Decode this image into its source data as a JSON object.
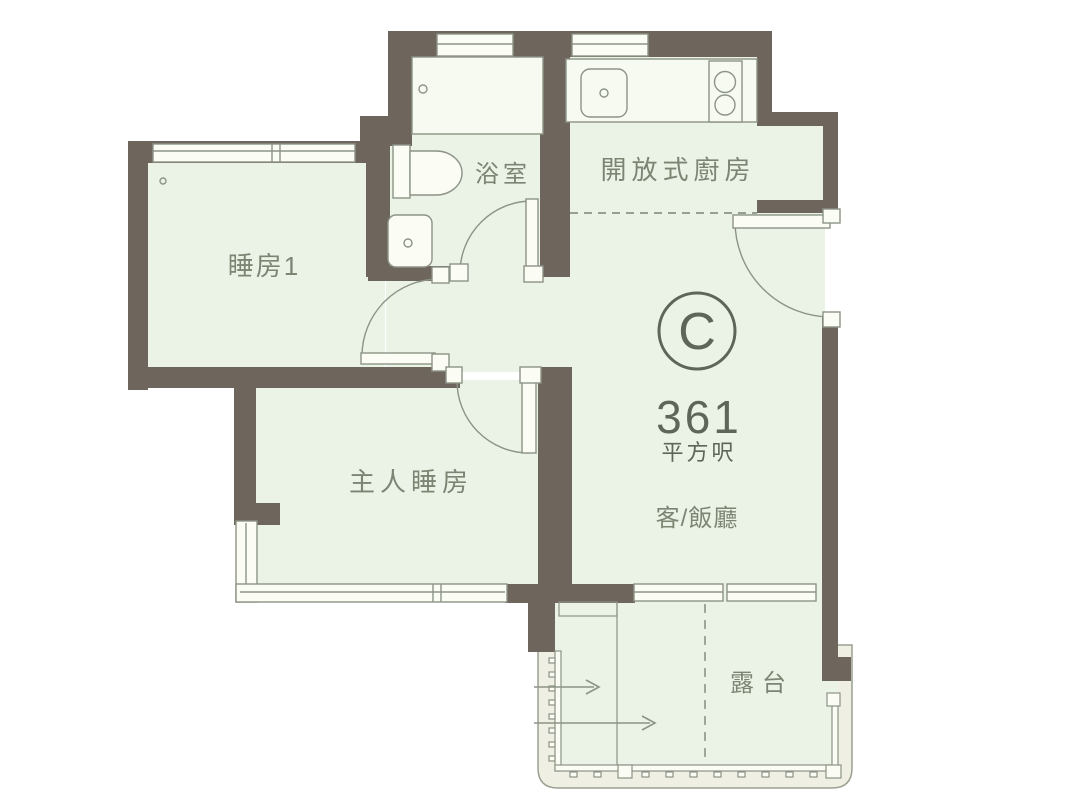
{
  "floor_plan": {
    "unit": {
      "letter": "C",
      "area_value": "361",
      "area_unit": "平方呎"
    },
    "rooms": {
      "bedroom1": {
        "label": "睡房1"
      },
      "bathroom": {
        "label": "浴室"
      },
      "open_kitchen": {
        "label": "開放式廚房"
      },
      "master_bedroom": {
        "label": "主人睡房"
      },
      "living_dining": {
        "label": "客/飯廳"
      },
      "balcony": {
        "label": "露台"
      }
    },
    "colors": {
      "wall": "#6e665d",
      "floor": "#eaf3e5",
      "fixture_stroke": "#8d9386",
      "label_text": "#7e8474",
      "badge": "#5f6558",
      "balcony_band": "#f0efe3",
      "background": "#ffffff"
    }
  }
}
